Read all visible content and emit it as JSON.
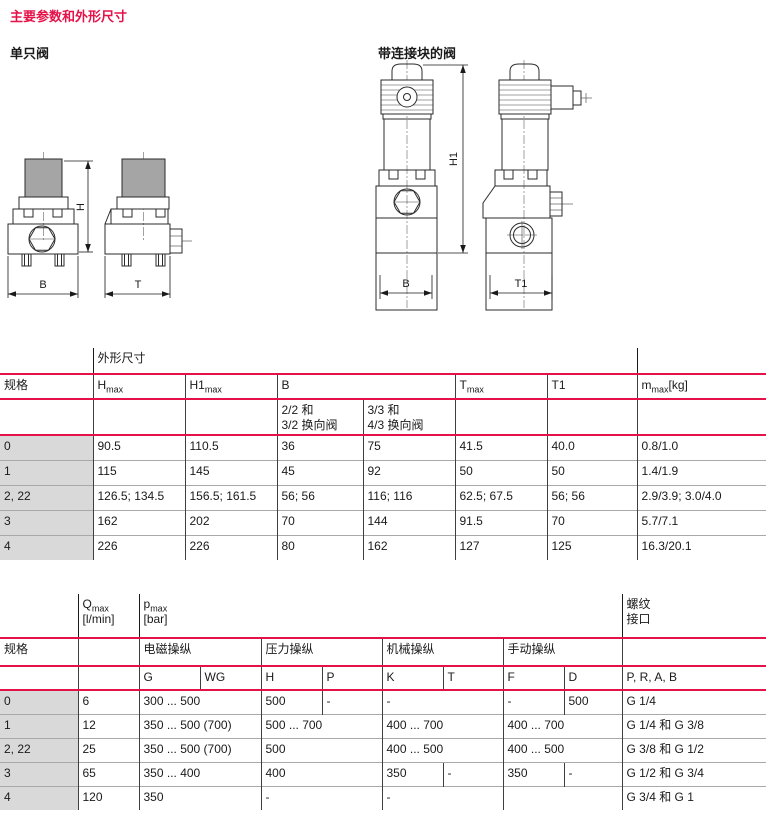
{
  "title": "主要参数和外形尺寸",
  "colors": {
    "accent": "#e51149",
    "spec_col_bg": "#d9d9d9"
  },
  "drawings": {
    "single_valve_label": "单只阀",
    "block_valve_label": "带连接块的阀",
    "dim_h": "H",
    "dim_b": "B",
    "dim_t": "T",
    "dim_h1": "H1",
    "dim_b2": "B",
    "dim_t1": "T1"
  },
  "dim_table": {
    "group_header": "外形尺寸",
    "spec_header": "规格",
    "col_h": {
      "base": "H",
      "sub": "max"
    },
    "col_h1": {
      "base": "H1",
      "sub": "max"
    },
    "col_b": {
      "base": "B"
    },
    "col_b_sub1_l1": "2/2 和",
    "col_b_sub1_l2": "3/2 换向阀",
    "col_b_sub2_l1": "3/3 和",
    "col_b_sub2_l2": "4/3 换向阀",
    "col_t": {
      "base": "T",
      "sub": "max"
    },
    "col_t1": {
      "base": "T1"
    },
    "col_m": {
      "base": "m",
      "sub": "max",
      "suffix": "[kg]"
    },
    "rows": [
      {
        "spec": "0",
        "hmax": "90.5",
        "h1max": "110.5",
        "b1": "36",
        "b2": "75",
        "tmax": "41.5",
        "t1": "40.0",
        "m": "0.8/1.0"
      },
      {
        "spec": "1",
        "hmax": "115",
        "h1max": "145",
        "b1": "45",
        "b2": "92",
        "tmax": "50",
        "t1": "50",
        "m": "1.4/1.9"
      },
      {
        "spec": "2, 22",
        "hmax": "126.5; 134.5",
        "h1max": "156.5; 161.5",
        "b1": "56; 56",
        "b2": "116; 116",
        "tmax": "62.5; 67.5",
        "t1": "56; 56",
        "m": "2.9/3.9; 3.0/4.0"
      },
      {
        "spec": "3",
        "hmax": "162",
        "h1max": "202",
        "b1": "70",
        "b2": "144",
        "tmax": "91.5",
        "t1": "70",
        "m": "5.7/7.1"
      },
      {
        "spec": "4",
        "hmax": "226",
        "h1max": "226",
        "b1": "80",
        "b2": "162",
        "tmax": "127",
        "t1": "125",
        "m": "16.3/20.1"
      }
    ]
  },
  "perf_table": {
    "spec_header": "规格",
    "q_header": {
      "base": "Q",
      "sub": "max",
      "unit": "[l/min]"
    },
    "p_header": {
      "base": "p",
      "sub": "max",
      "unit": "[bar]"
    },
    "thread_l1": "螺纹",
    "thread_l2": "接口",
    "group_solenoid": "电磁操纵",
    "group_pressure": "压力操纵",
    "group_mechanical": "机械操纵",
    "group_manual": "手动操纵",
    "sub_g": "G",
    "sub_wg": "WG",
    "sub_h": "H",
    "sub_p": "P",
    "sub_k": "K",
    "sub_t": "T",
    "sub_f": "F",
    "sub_d": "D",
    "thread_cols": "P, R, A, B",
    "rows": [
      {
        "spec": "0",
        "q": "6",
        "g": "300 ... 500",
        "h": "500",
        "p": "-",
        "k": "-",
        "f": "-",
        "d": "500",
        "thread": "G 1/4"
      },
      {
        "spec": "1",
        "q": "12",
        "g": "350 ... 500 (700)",
        "h": "500 ... 700",
        "k": "400 ... 700",
        "f": "400 ... 700",
        "thread": "G 1/4 和 G 3/8"
      },
      {
        "spec": "2, 22",
        "q": "25",
        "g": "350 ... 500 (700)",
        "h": "500",
        "k": "400 ... 500",
        "f": "400 ... 500",
        "thread": "G 3/8 和 G 1/2"
      },
      {
        "spec": "3",
        "q": "65",
        "g": "350 ... 400",
        "h": "400",
        "k": "350",
        "t": "-",
        "f": "350",
        "d": "-",
        "thread": "G 1/2 和 G 3/4"
      },
      {
        "spec": "4",
        "q": "120",
        "g": "350",
        "h": "-",
        "k": "-",
        "f": "",
        "thread": "G 3/4 和 G 1"
      }
    ]
  }
}
